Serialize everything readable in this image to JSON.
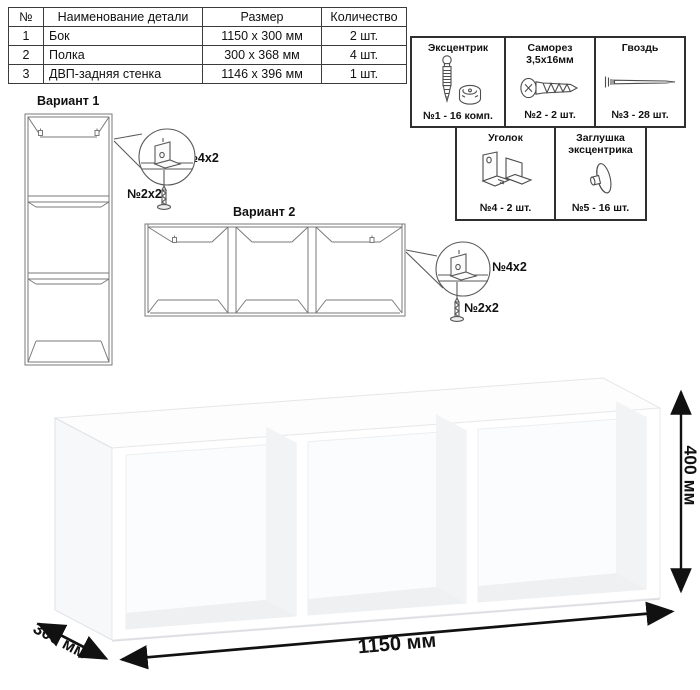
{
  "parts_table": {
    "headers": [
      "№",
      "Наименование детали",
      "Размер",
      "Количество"
    ],
    "rows": [
      {
        "num": "1",
        "name": "Бок",
        "size": "1150 x 300 мм",
        "qty": "2 шт."
      },
      {
        "num": "2",
        "name": "Полка",
        "size": "300 x 368 мм",
        "qty": "4 шт."
      },
      {
        "num": "3",
        "name": "ДВП-задняя стенка",
        "size": "1146 x 396 мм",
        "qty": "1 шт."
      }
    ]
  },
  "hardware": {
    "items": [
      {
        "name": "Эксцентрик",
        "name2": "",
        "count": "№1 - 16 комп."
      },
      {
        "name": "Саморез",
        "name2": "3,5х16мм",
        "count": "№2 - 2 шт."
      },
      {
        "name": "Гвоздь",
        "name2": "",
        "count": "№3 - 28 шт."
      },
      {
        "name": "Уголок",
        "name2": "",
        "count": "№4 - 2 шт."
      },
      {
        "name": "Заглушка",
        "name2": "эксцентрика",
        "count": "№5 - 16 шт."
      }
    ]
  },
  "variants": {
    "v1": {
      "title": "Вариант 1",
      "bracket_label": "№4х2",
      "screw_label": "№2х2"
    },
    "v2": {
      "title": "Вариант 2",
      "bracket_label": "№4х2",
      "screw_label": "№2х2"
    }
  },
  "dimensions": {
    "width": "1150 мм",
    "height": "400 мм",
    "depth": "300 мм"
  },
  "colors": {
    "outline": "#111111",
    "wireframe": "#7a7a7a",
    "box_border": "#2f2f2f",
    "interior_wall": "#f1f3f5",
    "interior_floor": "#eef0f2",
    "face": "#ffffff"
  }
}
